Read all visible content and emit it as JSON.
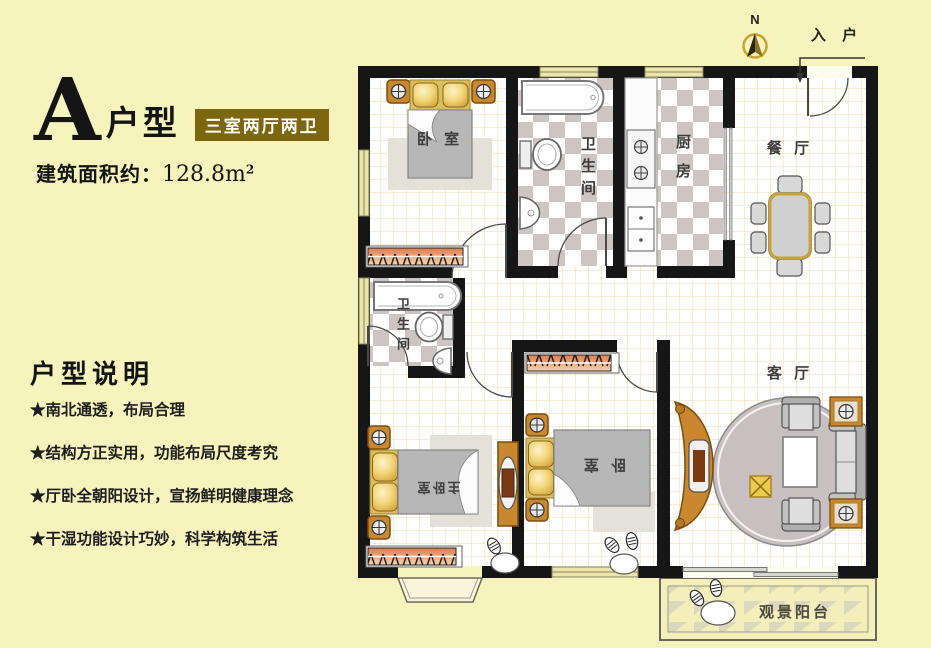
{
  "colors": {
    "background": "#f7f3bd",
    "badge_bg": "#7c660e",
    "wall": "#161616",
    "wood_accent": "#c9882f",
    "floor_grid": "#f2d8a4",
    "checker_tile": "#cfc4c4"
  },
  "header": {
    "type_letter": "A",
    "type_suffix": "户型",
    "badge": "三室两厅两卫",
    "area_label": "建筑面积约：",
    "area_value": "128.8m",
    "area_sup": "2"
  },
  "description": {
    "title": "户型说明",
    "items": [
      "★南北通透，布局合理",
      "★结构方正实用，功能布局尺度考究",
      "★厅卧全朝阳设计，宣扬鲜明健康理念",
      "★干湿功能设计巧妙，科学构筑生活"
    ]
  },
  "plan": {
    "compass_label": "N",
    "entrance_label": "入 户",
    "rooms": {
      "bedroom_top": "卧 室",
      "bathroom_top": "卫生间",
      "kitchen": "厨房",
      "dining": "餐 厅",
      "bathroom_mid": "卫生间",
      "master_bedroom": "主卧室",
      "bedroom_bottom": "卧 室",
      "living": "客 厅",
      "balcony": "观景阳台"
    }
  }
}
